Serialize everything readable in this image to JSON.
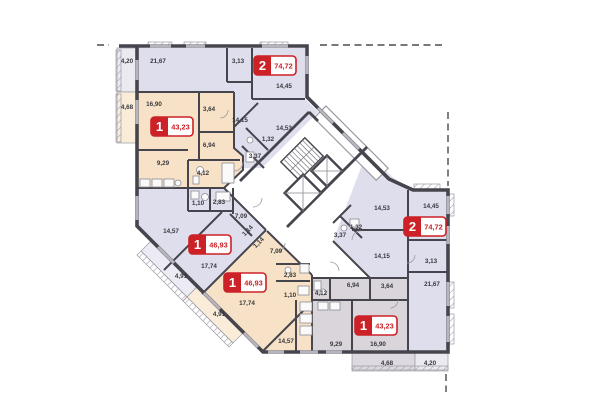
{
  "plan_type": "residential-floor-plan",
  "colors": {
    "badge_red": "#cb2127",
    "wall": "#46454d",
    "apt_lavender": "#dfdeed",
    "apt_peach": "#f7e2c8",
    "apt_gray": "#d9d5db",
    "balcony_lavender": "#ecebf4",
    "balcony_peach": "#f9edda",
    "balcony_gray": "#dcd9e0",
    "balcony_light": "#eceaf1",
    "label_text": "#38383d"
  },
  "badges": [
    {
      "num": "1",
      "area": "43,23"
    },
    {
      "num": "2",
      "area": "74,72"
    },
    {
      "num": "1",
      "area": "46,93"
    },
    {
      "num": "1",
      "area": "46,93"
    },
    {
      "num": "2",
      "area": "74,72"
    },
    {
      "num": "1",
      "area": "43,23"
    }
  ],
  "rooms": [
    "4,20",
    "21,67",
    "3,13",
    "14,45",
    "14,15",
    "14,53",
    "1,32",
    "3,37",
    "4,68",
    "16,90",
    "3,64",
    "6,94",
    "9,29",
    "4,12",
    "1,10",
    "2,83",
    "7,09",
    "1,14",
    "14,57",
    "17,74",
    "4,91",
    "1,14",
    "7,09",
    "2,83",
    "1,10",
    "17,74",
    "14,57",
    "4,91",
    "4,12",
    "14,53",
    "14,45",
    "1,32",
    "3,37",
    "14,15",
    "3,13",
    "21,67",
    "6,94",
    "3,64",
    "9,29",
    "16,90",
    "4,68",
    "4,20"
  ]
}
